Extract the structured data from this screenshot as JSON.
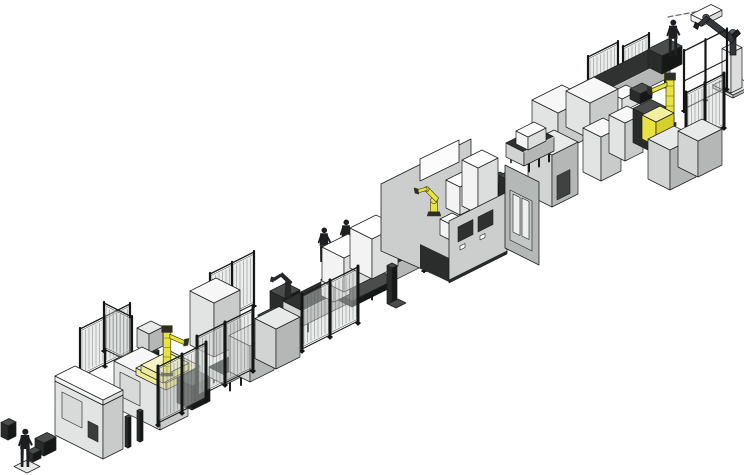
{
  "scene": {
    "background": "#ffffff",
    "stroke": "#1e201f",
    "palettes": {
      "palA": {
        "t": "#f6f7f6",
        "l": "#e2e4e3",
        "r": "#c8cbc9"
      },
      "palB": {
        "t": "#e8eae9",
        "l": "#d2d4d3",
        "r": "#b4b7b5"
      },
      "palW": {
        "t": "#ffffff",
        "l": "#f2f3f2",
        "r": "#dcdedd"
      },
      "palD": {
        "t": "#4a4d4b",
        "l": "#2a2c2b",
        "r": "#161817"
      },
      "palY": {
        "t": "#f3efa2",
        "l": "#e9e340",
        "r": "#d7d02c"
      },
      "palYp": {
        "t": "#f7f5c8",
        "l": "#efeb96",
        "r": "#e2dd74"
      }
    },
    "flat": {
      "palC_l": "#cbcecd",
      "palC_r2": "#b4b9b7",
      "conveyor_top": "#2f3230",
      "fence_panel": "rgba(208,212,210,0.45)",
      "robot_yellow": "#e9e340",
      "dark_metal": "#26282a",
      "human_dark": "#1d1f22"
    },
    "items": [
      {
        "t": "fence",
        "n": "fence-far-right-a",
        "axis": "u",
        "x": 588,
        "y": 102,
        "len": 30,
        "h": 46
      },
      {
        "t": "fence",
        "n": "fence-far-right-b",
        "axis": "u",
        "x": 623,
        "y": 90,
        "len": 26,
        "h": 44
      },
      {
        "t": "box",
        "n": "tool-shelf",
        "x": 702,
        "y": 26,
        "du": 20,
        "dv": 11,
        "h": 6,
        "p": "palW"
      },
      {
        "t": "box",
        "n": "robot-base-plate",
        "x": 733,
        "y": 98,
        "du": 20,
        "dv": 20,
        "h": 3,
        "p": "palB"
      },
      {
        "t": "box",
        "n": "robot-pedestal-column",
        "x": 731,
        "y": 93,
        "du": 11,
        "dv": 9,
        "h": 40,
        "p": "palW"
      },
      {
        "t": "sprite",
        "n": "ceiling-robot-arm",
        "k": "armtall",
        "x": 733,
        "y": 53,
        "s": 1
      },
      {
        "t": "sprite",
        "n": "spray-dashes",
        "k": "dashes",
        "x": 668,
        "y": 17,
        "s": 1
      },
      {
        "t": "conveyor",
        "n": "conveyor-upper",
        "x": 578,
        "y": 131,
        "du": 92,
        "dv": 20,
        "h": 26
      },
      {
        "t": "box",
        "n": "pallet",
        "x": 600,
        "y": 122,
        "du": 16,
        "dv": 12,
        "h": 13,
        "p": "palW"
      },
      {
        "t": "box",
        "n": "pallet",
        "x": 622,
        "y": 112,
        "du": 16,
        "dv": 12,
        "h": 13,
        "p": "palW"
      },
      {
        "t": "box",
        "n": "fixture-dark",
        "x": 640,
        "y": 104,
        "du": 12,
        "dv": 10,
        "h": 10,
        "p": "palD"
      },
      {
        "t": "box",
        "n": "cabinet",
        "x": 558,
        "y": 153,
        "du": 30,
        "dv": 26,
        "h": 40,
        "p": "palA"
      },
      {
        "t": "box",
        "n": "cabinet",
        "x": 590,
        "y": 139,
        "du": 28,
        "dv": 24,
        "h": 36,
        "p": "palA"
      },
      {
        "t": "box",
        "n": "cabinet",
        "x": 601,
        "y": 181,
        "du": 20,
        "dv": 18,
        "h": 44,
        "p": "palA"
      },
      {
        "t": "box",
        "n": "cabinet",
        "x": 625,
        "y": 161,
        "du": 18,
        "dv": 16,
        "h": 38,
        "p": "palA"
      },
      {
        "t": "box",
        "n": "machine-dark",
        "x": 648,
        "y": 150,
        "du": 18,
        "dv": 15,
        "h": 34,
        "p": "palD"
      },
      {
        "t": "box",
        "n": "operator-platform",
        "x": 662,
        "y": 74,
        "du": 20,
        "dv": 14,
        "h": 18,
        "p": "palD"
      },
      {
        "t": "sprite",
        "n": "operator",
        "k": "human",
        "x": 673,
        "y": 56,
        "s": 0.95
      },
      {
        "t": "sprite",
        "n": "gantry-robot-yellow",
        "k": "ymast",
        "x": 670,
        "y": 126,
        "s": 1
      },
      {
        "t": "box",
        "n": "fixture-yellow",
        "x": 656,
        "y": 146,
        "du": 18,
        "dv": 14,
        "h": 24,
        "p": "palY"
      },
      {
        "t": "fence",
        "n": "machine-frame",
        "axis": "u",
        "x": 684,
        "y": 112,
        "len": 43,
        "h": 62,
        "frame": true
      },
      {
        "t": "fence",
        "n": "fence-right-cage",
        "axis": "u",
        "x": 686,
        "y": 148,
        "len": 38,
        "h": 56,
        "heavy": true
      },
      {
        "t": "box",
        "n": "cabinet",
        "x": 670,
        "y": 190,
        "du": 26,
        "dv": 22,
        "h": 40,
        "p": "palB"
      },
      {
        "t": "box",
        "n": "cabinet",
        "x": 698,
        "y": 177,
        "du": 24,
        "dv": 20,
        "h": 36,
        "p": "palB"
      },
      {
        "t": "box",
        "n": "cabinet-tall",
        "x": 552,
        "y": 207,
        "du": 26,
        "dv": 24,
        "h": 52,
        "p": "palB"
      },
      {
        "t": "decalR",
        "n": "cabinet-door-dark",
        "x": 557,
        "y": 200,
        "len": 13,
        "h": 24,
        "f": "#3f4240"
      },
      {
        "t": "conveyor",
        "n": "conveyor-link",
        "x": 524,
        "y": 174,
        "du": 30,
        "dv": 18,
        "h": 22
      },
      {
        "t": "box",
        "n": "pallet",
        "x": 528,
        "y": 150,
        "du": 18,
        "dv": 12,
        "h": 13,
        "p": "palW"
      },
      {
        "t": "fence",
        "n": "fence-mid-far",
        "axis": "u",
        "x": 424,
        "y": 272,
        "len": 30,
        "h": 46
      },
      {
        "t": "sprite",
        "n": "operator",
        "k": "human",
        "x": 324,
        "y": 262,
        "s": 0.9
      },
      {
        "t": "sprite",
        "n": "operator",
        "k": "human",
        "x": 346,
        "y": 254,
        "s": 0.9
      },
      {
        "t": "box",
        "n": "robot-pedestal",
        "x": 284,
        "y": 320,
        "du": 16,
        "dv": 14,
        "h": 22,
        "p": "palD"
      },
      {
        "t": "sprite",
        "n": "handling-robot",
        "k": "darkrobot",
        "x": 288,
        "y": 298,
        "s": 1
      },
      {
        "t": "box",
        "n": "stand-dark",
        "x": 272,
        "y": 362,
        "du": 16,
        "dv": 14,
        "h": 40,
        "p": "palD"
      },
      {
        "t": "conveyor",
        "n": "conveyor-main",
        "x": 303,
        "y": 334,
        "du": 138,
        "dv": 20,
        "h": 23
      },
      {
        "t": "box",
        "n": "stand",
        "x": 352,
        "y": 307,
        "du": 44,
        "dv": 26,
        "h": 6,
        "p": "palD"
      },
      {
        "t": "box",
        "n": "machine-white",
        "x": 334,
        "y": 302,
        "du": 16,
        "dv": 13,
        "h": 16,
        "p": "palW"
      },
      {
        "t": "box",
        "n": "machine-white",
        "x": 344,
        "y": 292,
        "du": 26,
        "dv": 22,
        "h": 34,
        "p": "palW"
      },
      {
        "t": "box",
        "n": "machine-white",
        "x": 372,
        "y": 279,
        "du": 26,
        "dv": 22,
        "h": 40,
        "p": "palW"
      },
      {
        "t": "box",
        "n": "marker-yellow",
        "x": 418,
        "y": 243,
        "du": 9,
        "dv": 7,
        "h": 5,
        "p": "palY"
      },
      {
        "t": "box",
        "n": "post-dark",
        "x": 392,
        "y": 306,
        "du": 5,
        "dv": 5,
        "h": 38,
        "p": "palD"
      },
      {
        "t": "box",
        "n": "post-foot",
        "x": 396,
        "y": 310,
        "du": 10,
        "dv": 8,
        "h": 2,
        "p": "palD"
      },
      {
        "t": "fence",
        "n": "fence-mid-near",
        "axis": "u",
        "x": 302,
        "y": 352,
        "len": 56,
        "h": 58,
        "heavy": true
      },
      {
        "t": "poly",
        "n": "cell-wall-left",
        "pts": [
          [
            381,
            184
          ],
          [
            471,
            139
          ],
          [
            471,
            205
          ],
          [
            449,
            281
          ],
          [
            381,
            251
          ]
        ],
        "f": "palC_l",
        "st": true
      },
      {
        "t": "poly",
        "n": "cell-window",
        "pts": [
          [
            420,
            181
          ],
          [
            459,
            162
          ],
          [
            459,
            140
          ],
          [
            420,
            159
          ]
        ],
        "f": "#fcfcfc",
        "st": true
      },
      {
        "t": "poly",
        "n": "cell-passage-dark",
        "pts": [
          [
            420,
            268
          ],
          [
            449,
            282
          ],
          [
            449,
            258
          ],
          [
            420,
            244
          ]
        ],
        "f": "#2b2d2c",
        "st": false
      },
      {
        "t": "poly",
        "n": "cell-floor",
        "pts": [
          [
            449,
            277
          ],
          [
            451,
            245
          ],
          [
            533,
            206
          ],
          [
            531,
            238
          ]
        ],
        "f": "#ebedec",
        "st": true
      },
      {
        "t": "box",
        "n": "cell-fixture-dark",
        "x": 496,
        "y": 206,
        "du": 14,
        "dv": 10,
        "h": 22,
        "p": "palD"
      },
      {
        "t": "box",
        "n": "cell-fixture-dark",
        "x": 508,
        "y": 200,
        "du": 12,
        "dv": 9,
        "h": 20,
        "p": "palD"
      },
      {
        "t": "box",
        "n": "cell-machine-white",
        "x": 450,
        "y": 240,
        "du": 12,
        "dv": 10,
        "h": 16,
        "p": "palW"
      },
      {
        "t": "box",
        "n": "cell-machine-white",
        "x": 460,
        "y": 215,
        "du": 16,
        "dv": 14,
        "h": 28,
        "p": "palW"
      },
      {
        "t": "box",
        "n": "cell-machine-white",
        "x": 478,
        "y": 214,
        "du": 20,
        "dv": 16,
        "h": 46,
        "p": "palW"
      },
      {
        "t": "sprite",
        "n": "cell-robot-yellow",
        "k": "yrobot",
        "x": 434,
        "y": 216,
        "s": 0.85
      },
      {
        "t": "poly",
        "n": "cell-wall-front",
        "pts": [
          [
            449,
            281
          ],
          [
            507,
            252
          ],
          [
            507,
            192
          ],
          [
            449,
            221
          ]
        ],
        "f": "palC_l",
        "st": true
      },
      {
        "t": "decalR",
        "n": "cell-slot-window",
        "x": 458,
        "y": 242,
        "len": 15,
        "h": 15,
        "f": "#2f3130"
      },
      {
        "t": "decalR",
        "n": "cell-slot-window",
        "x": 478,
        "y": 232,
        "len": 15,
        "h": 15,
        "f": "#2f3130"
      },
      {
        "t": "decalR",
        "n": "cell-sill",
        "x": 460,
        "y": 250,
        "len": 5,
        "h": 4,
        "f": "#ffffff"
      },
      {
        "t": "decalR",
        "n": "cell-sill",
        "x": 480,
        "y": 240,
        "len": 5,
        "h": 4,
        "f": "#ffffff"
      },
      {
        "t": "decalR",
        "n": "cell-skirt",
        "x": 449,
        "y": 283,
        "len": 58,
        "h": 3,
        "f": "#2a2c2b"
      },
      {
        "t": "poly",
        "n": "cell-wall-right",
        "pts": [
          [
            505,
            248
          ],
          [
            539,
            265
          ],
          [
            539,
            182
          ],
          [
            505,
            165
          ]
        ],
        "f": "palC_r2",
        "st": true
      },
      {
        "t": "decalL",
        "n": "cell-door-frame",
        "x": 510,
        "y": 240,
        "len": 22,
        "h": 50,
        "f": "#c3c7c5"
      },
      {
        "t": "decalL",
        "n": "cell-door-glass",
        "x": 513,
        "y": 232,
        "len": 7,
        "h": 38,
        "f": "#eef0ef"
      },
      {
        "t": "decalL",
        "n": "cell-door-glass",
        "x": 522,
        "y": 236,
        "len": 7,
        "h": 38,
        "f": "#eef0ef"
      },
      {
        "t": "fence",
        "n": "fence-cell2-far-a",
        "axis": "u",
        "x": 80,
        "y": 380,
        "len": 50,
        "h": 52
      },
      {
        "t": "fence",
        "n": "fence-cell2-far-b",
        "axis": "v",
        "x": 104,
        "y": 352,
        "len": 28,
        "h": 50
      },
      {
        "t": "box",
        "n": "panel-post",
        "x": 156,
        "y": 372,
        "du": 3,
        "dv": 3,
        "h": 20,
        "p": "palD"
      },
      {
        "t": "box",
        "n": "control-panel",
        "x": 149,
        "y": 353,
        "du": 14,
        "dv": 12,
        "h": 19,
        "p": "palB"
      },
      {
        "t": "fence",
        "n": "fence-cage2-far",
        "axis": "u",
        "x": 210,
        "y": 329,
        "len": 44,
        "h": 56
      },
      {
        "t": "box",
        "n": "cabinet-tall",
        "x": 214,
        "y": 357,
        "du": 26,
        "dv": 24,
        "h": 54,
        "p": "palA"
      },
      {
        "t": "box",
        "n": "cabinet-large",
        "x": 160,
        "y": 430,
        "du": 28,
        "dv": 46,
        "h": 46,
        "p": "palA"
      },
      {
        "t": "decalL",
        "n": "cabinet-door",
        "x": 120,
        "y": 396,
        "len": 20,
        "h": 24,
        "f": "#d8dad9"
      },
      {
        "t": "box",
        "n": "robot-plinth-lower",
        "x": 166,
        "y": 390,
        "du": 34,
        "dv": 30,
        "h": 7,
        "p": "palYp"
      },
      {
        "t": "box",
        "n": "robot-plinth-upper",
        "x": 163,
        "y": 383,
        "du": 26,
        "dv": 22,
        "h": 7,
        "p": "palYp"
      },
      {
        "t": "sprite",
        "n": "line-robot-yellow",
        "k": "ymast",
        "x": 167,
        "y": 376,
        "s": 0.95,
        "flip": true
      },
      {
        "t": "box",
        "n": "machine-dark",
        "x": 192,
        "y": 410,
        "du": 18,
        "dv": 15,
        "h": 24,
        "p": "palD"
      },
      {
        "t": "conveyor",
        "n": "conveyor-left",
        "x": 225,
        "y": 393,
        "du": 32,
        "dv": 16,
        "h": 18
      },
      {
        "t": "box",
        "n": "cabinet",
        "x": 250,
        "y": 382,
        "du": 24,
        "dv": 21,
        "h": 36,
        "p": "palB"
      },
      {
        "t": "box",
        "n": "cabinet",
        "x": 276,
        "y": 369,
        "du": 24,
        "dv": 21,
        "h": 40,
        "p": "palB"
      },
      {
        "t": "fence",
        "n": "fence-cage2-near",
        "axis": "u",
        "x": 197,
        "y": 400,
        "len": 56,
        "h": 64,
        "heavy": true
      },
      {
        "t": "fence",
        "n": "fence-cell2-near",
        "axis": "u",
        "x": 158,
        "y": 426,
        "len": 48,
        "h": 60,
        "heavy": true
      },
      {
        "t": "box",
        "n": "fence-post",
        "x": 128,
        "y": 448,
        "du": 3,
        "dv": 3,
        "h": 30,
        "p": "palD"
      },
      {
        "t": "box",
        "n": "fence-post",
        "x": 140,
        "y": 442,
        "du": 3,
        "dv": 3,
        "h": 30,
        "p": "palD"
      },
      {
        "t": "box",
        "n": "line-stop",
        "x": 8,
        "y": 440,
        "du": 8,
        "dv": 7,
        "h": 14,
        "p": "palD"
      },
      {
        "t": "box",
        "n": "cabinet-main",
        "x": 103,
        "y": 459,
        "du": 20,
        "dv": 48,
        "h": 54,
        "p": "palA"
      },
      {
        "t": "box",
        "n": "cabinet-lid",
        "x": 103,
        "y": 405,
        "du": 20,
        "dv": 48,
        "h": 5,
        "p": "palW"
      },
      {
        "t": "decalL",
        "n": "cabinet-door",
        "x": 62,
        "y": 418,
        "len": 20,
        "h": 26,
        "f": "#d8dad9"
      },
      {
        "t": "decalL",
        "n": "cabinet-vent-dark",
        "x": 88,
        "y": 437,
        "len": 10,
        "h": 16,
        "f": "#3a3d3b"
      },
      {
        "t": "box",
        "n": "infeed-stand",
        "x": 44,
        "y": 456,
        "du": 12,
        "dv": 9,
        "h": 13,
        "p": "palD"
      },
      {
        "t": "box",
        "n": "infeed-stub",
        "x": 33,
        "y": 462,
        "du": 8,
        "dv": 6,
        "h": 8,
        "p": "palD"
      },
      {
        "t": "box",
        "n": "operator-plate",
        "x": 27,
        "y": 474,
        "du": 13,
        "dv": 13,
        "h": 1,
        "p": "palB"
      },
      {
        "t": "sprite",
        "n": "operator",
        "k": "human",
        "x": 25,
        "y": 467,
        "s": 1
      }
    ]
  }
}
